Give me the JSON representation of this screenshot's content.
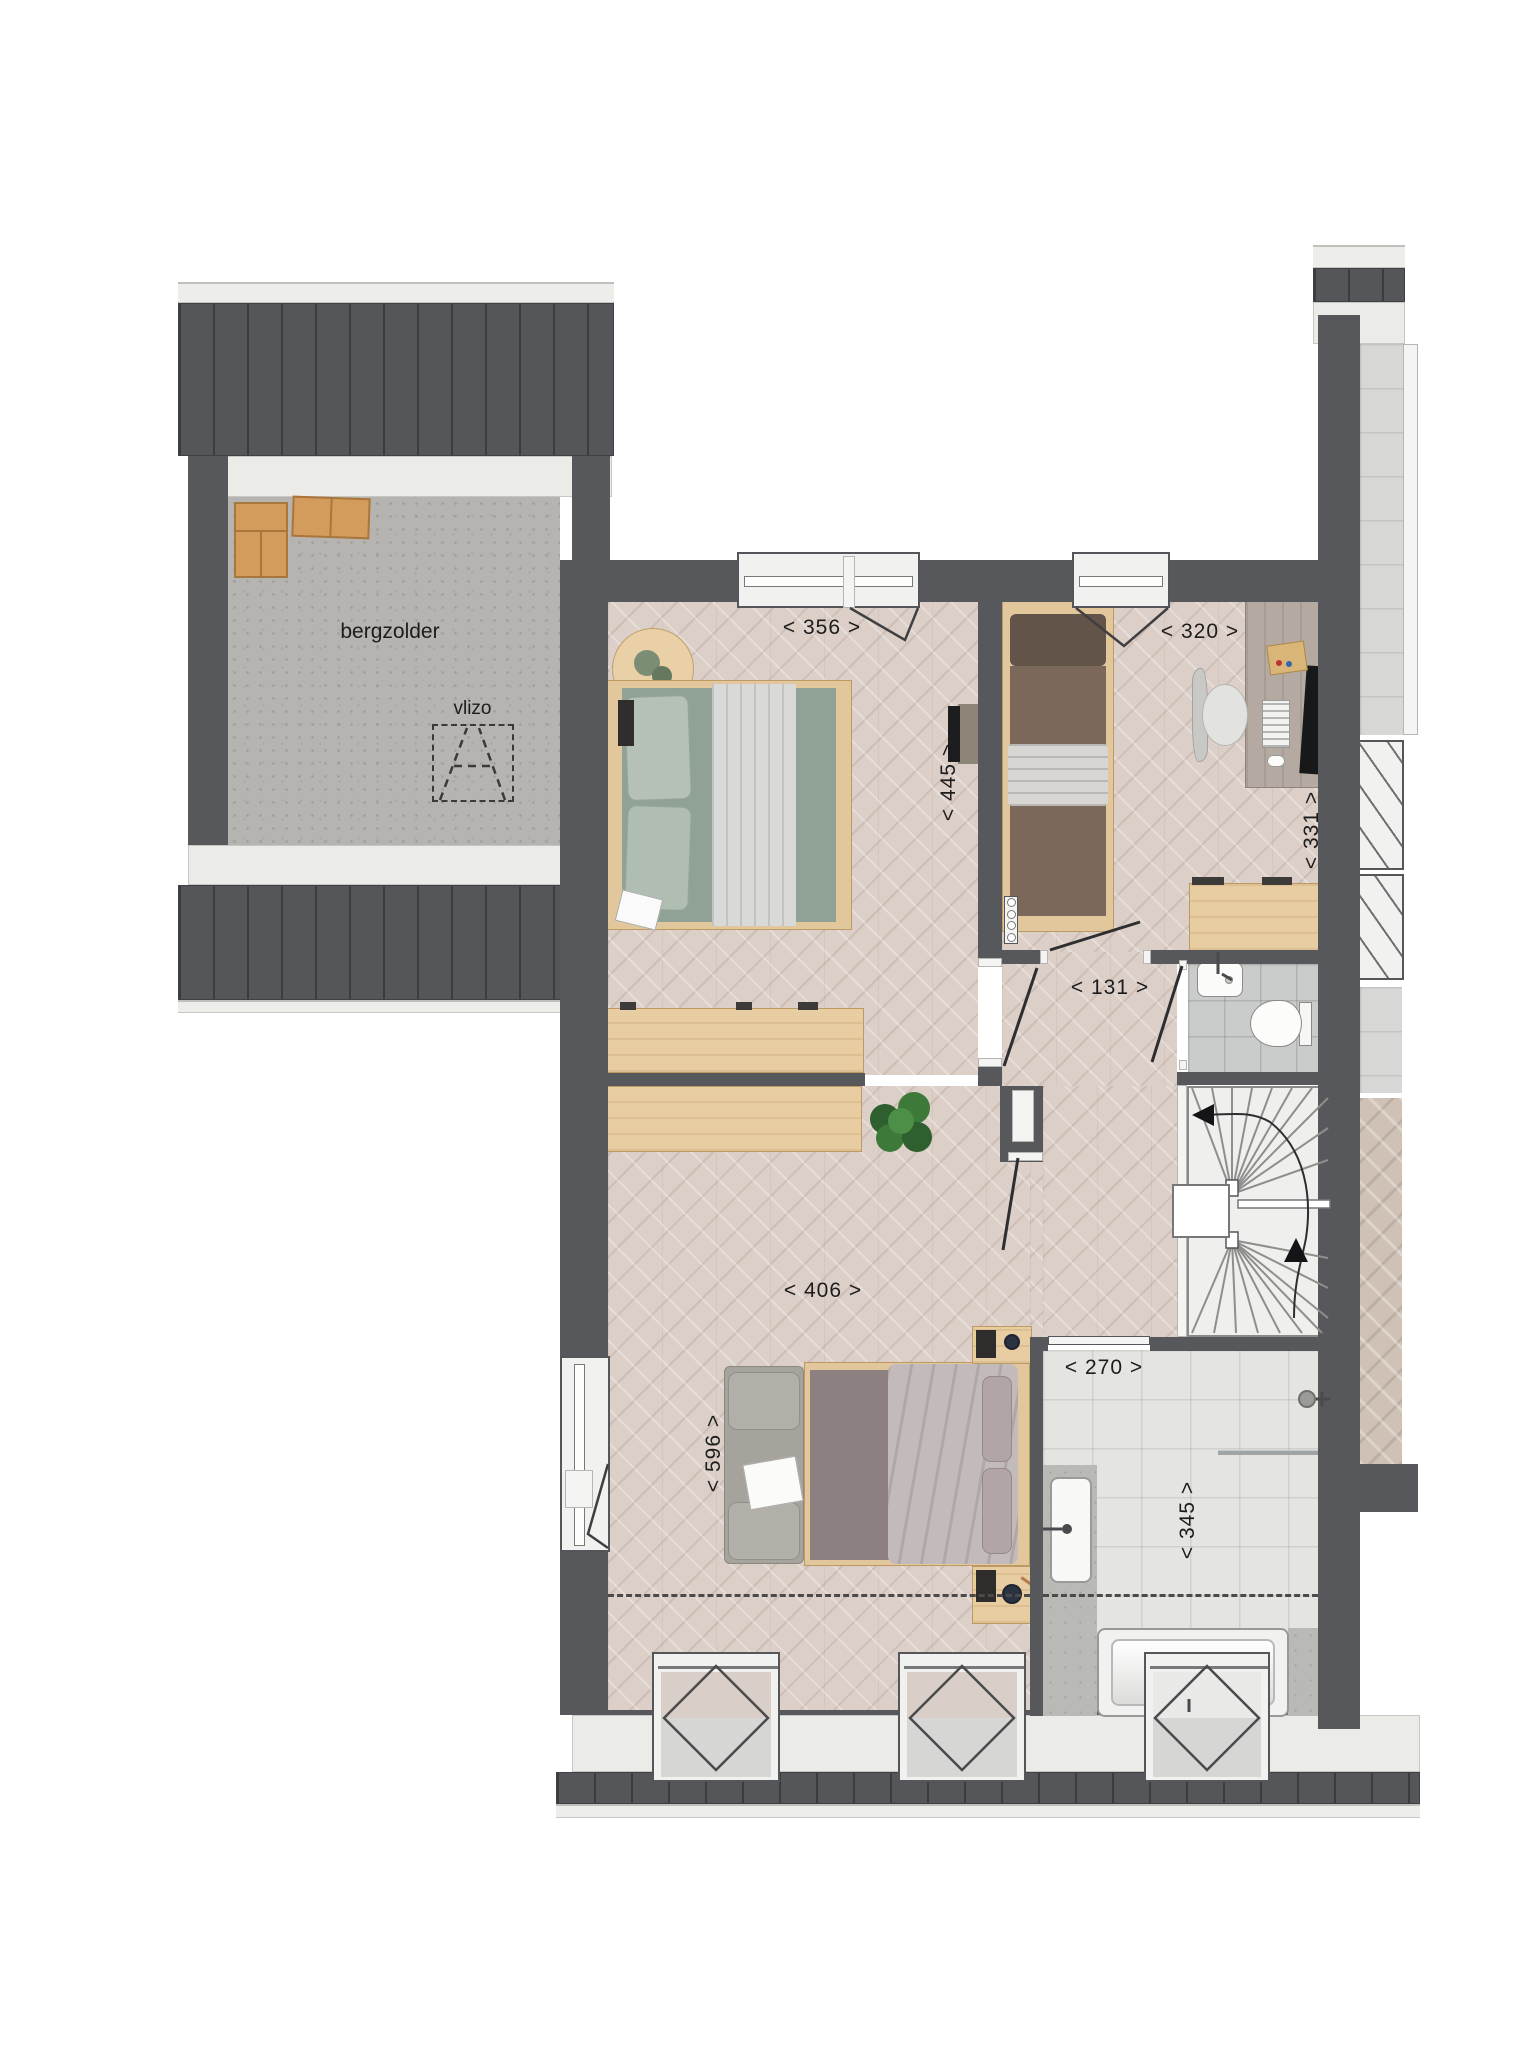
{
  "plan": {
    "labels": {
      "attic_room": "bergzolder",
      "attic_hatch": "vlizo"
    },
    "dimensions": {
      "bedroom1_width": "< 356 >",
      "bedroom2_width": "< 320 >",
      "bedroom1_depth": "< 445 >",
      "bedroom2_depth": "< 331 >",
      "hallway_width": "< 131 >",
      "bedroom3_width": "< 406 >",
      "bedroom3_depth": "< 596 >",
      "bathroom_width": "< 270 >",
      "bathroom_depth": "< 345 >"
    },
    "colors": {
      "wall": "#56585b",
      "roof": "#54565a",
      "wood_floor": "#dccfc8",
      "concrete_floor": "#b6b4b0",
      "bath_tile": "#e4e4e1",
      "toilet_tile": "#cacccb",
      "furniture_wood": "#e8cda3",
      "green_bedding": "#8fa295",
      "brown_bedding": "#7c685b",
      "mauve_bedding": "#8c8080",
      "plant_green": "#3d7a39",
      "cardboard": "#d49c5c"
    }
  }
}
